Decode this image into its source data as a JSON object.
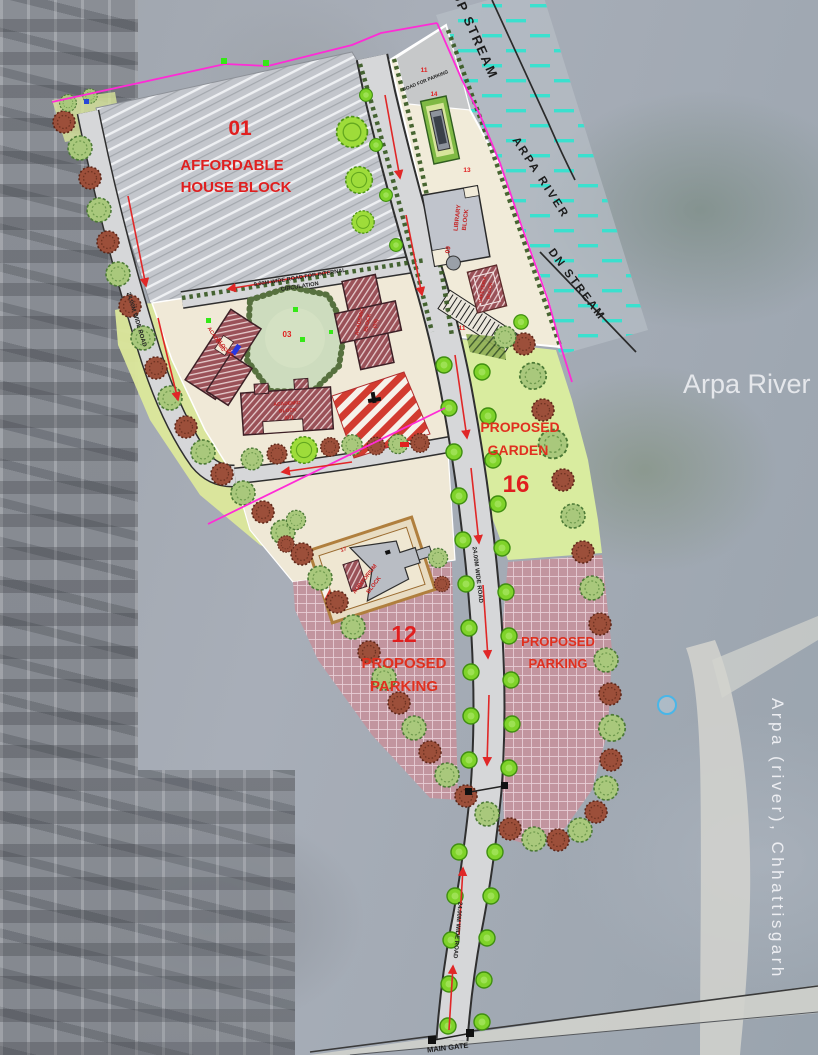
{
  "river": {
    "big_label": "Arpa River",
    "vertical_label": "Arpa (river), Chhattisgarh",
    "up_stream": "UP STREAM",
    "dn_stream": "DN STREAM",
    "strip_label": "ARPA RIVER"
  },
  "zones": {
    "affordable": {
      "number": "01",
      "name_l1": "AFFORDABLE",
      "name_l2": "HOUSE BLOCK"
    },
    "garden": {
      "number": "16",
      "name_l1": "PROPOSED",
      "name_l2": "GARDEN"
    },
    "parking_main": {
      "number": "12",
      "name_l1": "PROPOSED",
      "name_l2": "PARKING"
    },
    "parking_east": {
      "name_l1": "PROPOSED",
      "name_l2": "PARKING"
    },
    "central_court": {
      "number": "03"
    },
    "road_for_parking": {
      "number": "11",
      "note": "ROAD FOR PARKING"
    },
    "riverside_strip": {
      "number": "13"
    },
    "play_court": {
      "number": "14"
    },
    "parking_stalls": {
      "number": "11"
    }
  },
  "buildings": {
    "academic_west": {
      "l1": "ACADEMIC",
      "l2": "BLOCK",
      "l3": "(04)"
    },
    "academic_east": {
      "l1": "ACADEMIC",
      "l2": "BLOCK",
      "l3": "(05)"
    },
    "academic_south": {
      "l1": "ACADEMIC",
      "l2": "BLOCK",
      "l3": "(07)"
    },
    "library": {
      "l1": "LIBRARY",
      "l2": "BLOCK",
      "number": "09"
    },
    "cafeteria": {
      "l1": "CAFETERIA",
      "l2": "BLOCK"
    },
    "auditorium": {
      "l1": "AUDITORIUM",
      "l2": "BLOCK",
      "number": "17"
    }
  },
  "roads": {
    "internal_l1": "9.00M WIDE ROAD FOR INTERNAL",
    "internal_l2": "CIRCULATION",
    "west": "24.00M WIDE ROAD",
    "main": "24.00M WIDE ROAD",
    "south": "24.00M WIDE ROAD",
    "main_gate": "MAIN GATE"
  },
  "colors": {
    "label_red": "#e01f1f",
    "boundary_magenta": "#ff2bd6",
    "river_dash": "#35e2cf"
  }
}
